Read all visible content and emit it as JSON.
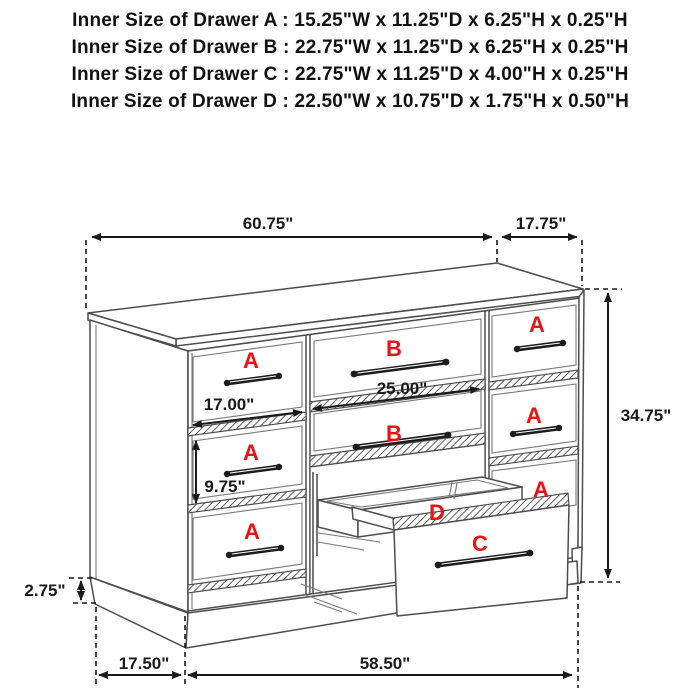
{
  "header": {
    "lines": [
      "Inner Size of Drawer A : 15.25\"W x 11.25\"D x 6.25\"H x 0.25\"H",
      "Inner Size of Drawer B : 22.75\"W x 11.25\"D x 6.25\"H x 0.25\"H",
      "Inner Size of Drawer C : 22.75\"W x 11.25\"D x 4.00\"H x 0.25\"H",
      "Inner Size of Drawer D : 22.50\"W x 10.75\"D x 1.75\"H x 0.50\"H"
    ]
  },
  "dimensions": {
    "top_width": "60.75\"",
    "top_depth": "17.75\"",
    "height": "34.75\"",
    "drawer_a_width": "17.00\"",
    "drawer_b_width": "25.00\"",
    "drawer_a_height": "9.75\"",
    "base_height": "2.75\"",
    "side_depth": "17.50\"",
    "front_width": "58.50\""
  },
  "markers": {
    "left_a1": "A",
    "left_a2": "A",
    "left_a3": "A",
    "mid_b1": "B",
    "mid_b2": "B",
    "right_a1": "A",
    "right_a2": "A",
    "right_a3": "A",
    "tray_d": "D",
    "drawer_c": "C"
  },
  "colors": {
    "label_red": "#ee1111",
    "line": "#4d4d4d",
    "dimension": "#1a1a1a"
  }
}
